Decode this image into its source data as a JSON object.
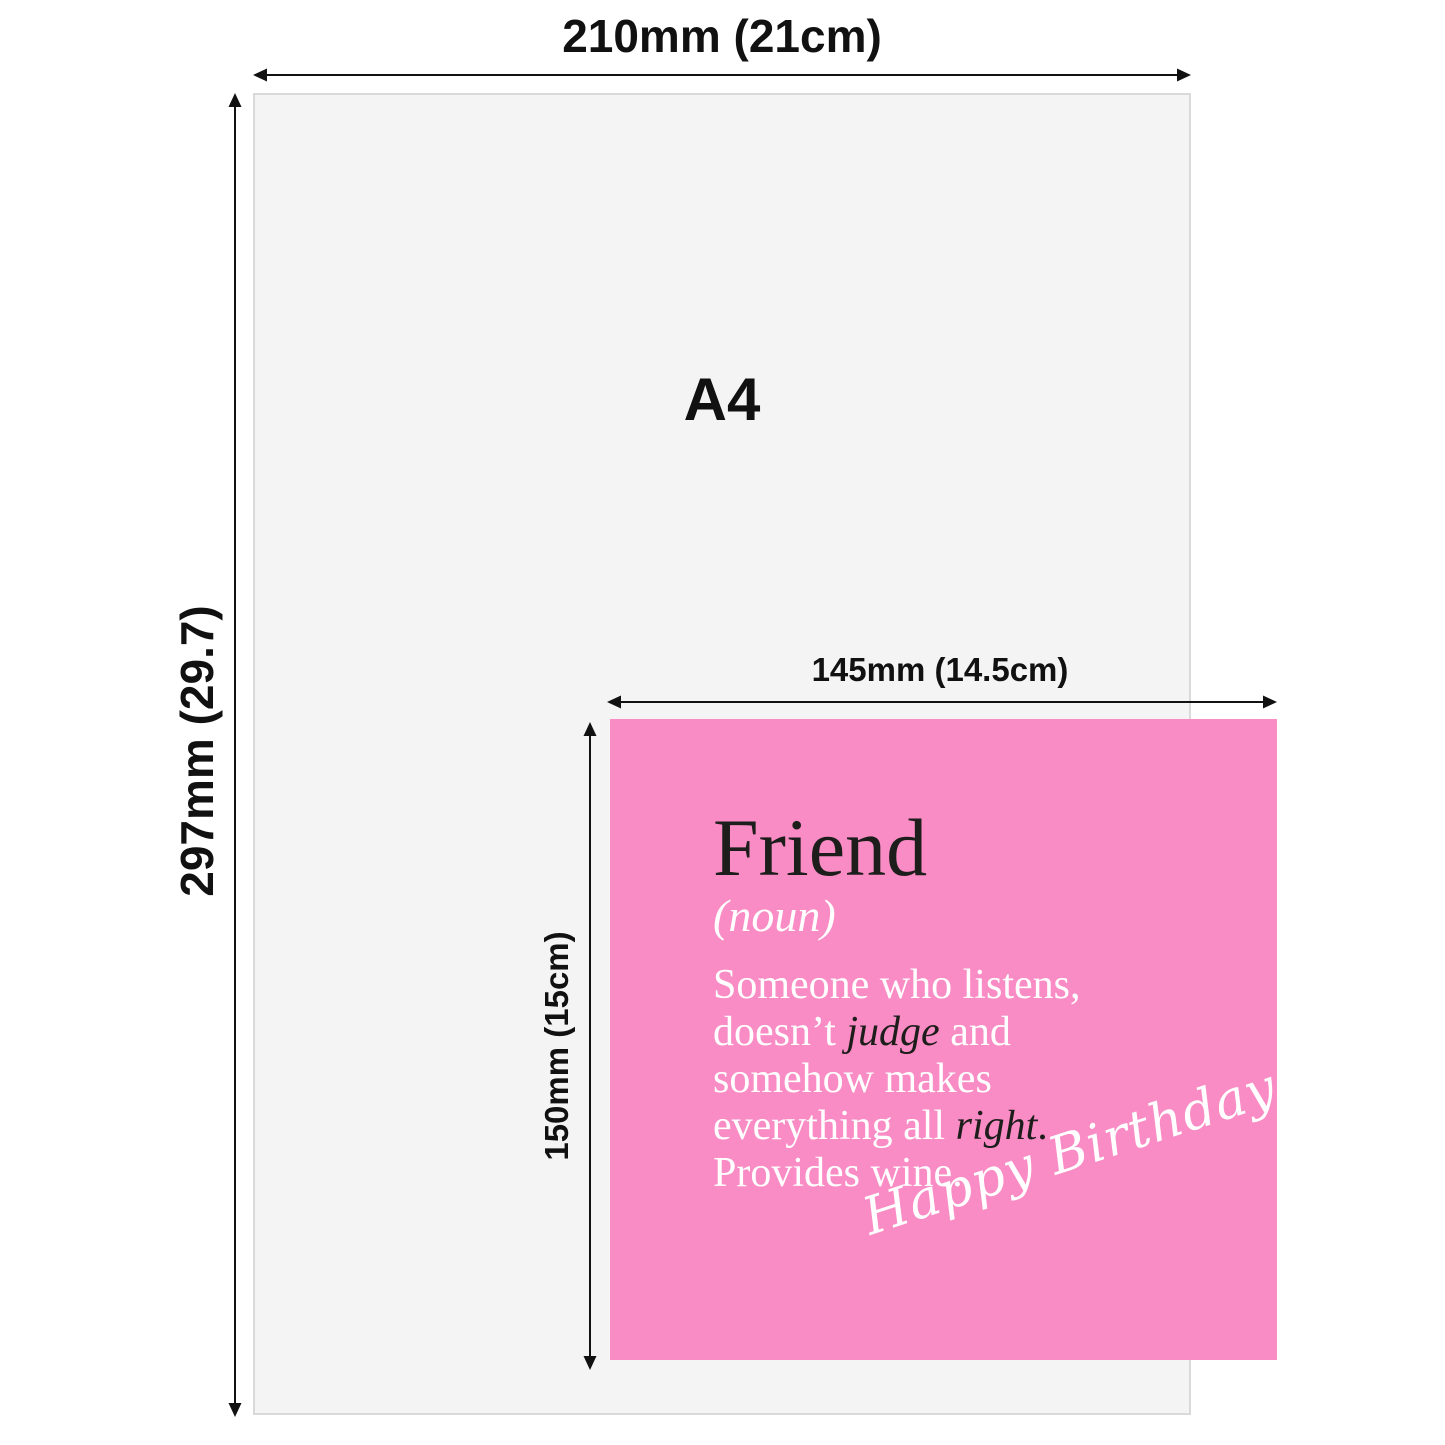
{
  "colors": {
    "background": "#ffffff",
    "paper_fill": "#f4f4f4",
    "paper_border": "#d9d9d9",
    "ink": "#111111",
    "card_pink": "#f98cc4",
    "card_text": "#ffffff",
    "card_title": "#1d1d1b",
    "emphasis": "#1d1d1b"
  },
  "a4_sheet": {
    "label": "A4"
  },
  "dimensions": {
    "a4_width": {
      "label": "210mm (21cm)"
    },
    "a4_height": {
      "label": "297mm (29.7)"
    },
    "card_width": {
      "label": "145mm (14.5cm)"
    },
    "card_height": {
      "label": "150mm (15cm)"
    }
  },
  "card": {
    "title": "Friend",
    "subtitle": "(noun)",
    "body_lines": [
      {
        "segments": [
          {
            "text": "Someone who listens,"
          }
        ]
      },
      {
        "segments": [
          {
            "text": "doesn’t "
          },
          {
            "text": "judge",
            "italic": true,
            "color": "#1d1d1b"
          },
          {
            "text": " and"
          }
        ]
      },
      {
        "segments": [
          {
            "text": "somehow makes"
          }
        ]
      },
      {
        "segments": [
          {
            "text": "everything all "
          },
          {
            "text": "right",
            "italic": true,
            "color": "#1d1d1b"
          },
          {
            "text": ".",
            "color": "#1d1d1b"
          }
        ]
      },
      {
        "segments": [
          {
            "text": "Provides wine."
          }
        ]
      }
    ],
    "signature": "Happy Birthday"
  }
}
